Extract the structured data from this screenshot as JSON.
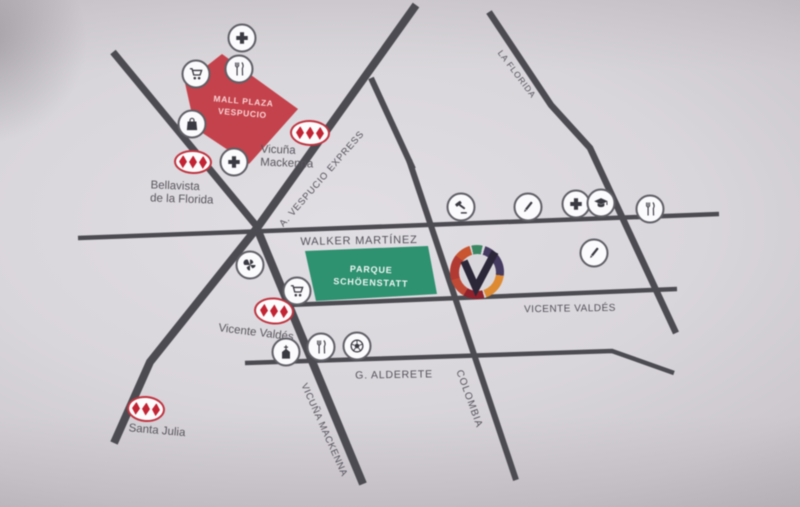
{
  "streets": [
    {
      "id": "walker-martinez",
      "label": "WALKER MARTÍNEZ"
    },
    {
      "id": "vicente-valdes",
      "label": "VICENTE VALDÉS"
    },
    {
      "id": "g-alderete",
      "label": "G. ALDERETE"
    },
    {
      "id": "a-vespucio-express",
      "label": "A. VESPUCIO EXPRESS"
    },
    {
      "id": "la-florida",
      "label": "LA FLORIDA"
    },
    {
      "id": "vicuna-mackenna",
      "label": "VICUÑA MACKENNA"
    },
    {
      "id": "colombia",
      "label": "COLOMBIA"
    }
  ],
  "landmarks": {
    "mall": {
      "line1": "MALL PLAZA",
      "line2": "VESPUCIO",
      "color": "#c4424b"
    },
    "park": {
      "line1": "PARQUE",
      "line2": "SCHÖENSTATT",
      "color": "#2e916f"
    }
  },
  "metro_stations": [
    {
      "id": "vicuna-mackenna",
      "line1": "Vicuña",
      "line2": "Mackenna"
    },
    {
      "id": "bellavista-de-la-florida",
      "line1": "Bellavista",
      "line2": "de la Florida"
    },
    {
      "id": "vicente-valdes",
      "line1": "Vicente Valdés"
    },
    {
      "id": "santa-julia",
      "line1": "Santa Julia"
    }
  ],
  "logo": {
    "letter": "V",
    "ring_colors": [
      "#3c8763",
      "#453a60",
      "#dd8a33",
      "#8f222c",
      "#c14a36",
      "#b13a33",
      "#c85430"
    ]
  },
  "amenities": [
    "hospital",
    "supermarket",
    "restaurant",
    "shopping-bag",
    "hospital",
    "pinwheel-landmark",
    "supermarket",
    "church",
    "restaurant",
    "stadium",
    "courthouse",
    "school",
    "hospital",
    "university",
    "restaurant",
    "school"
  ],
  "colors": {
    "road": "#4b4b51",
    "metro_red": "#c32433",
    "street_label": "#54505a",
    "paper": "#d9d6db"
  }
}
